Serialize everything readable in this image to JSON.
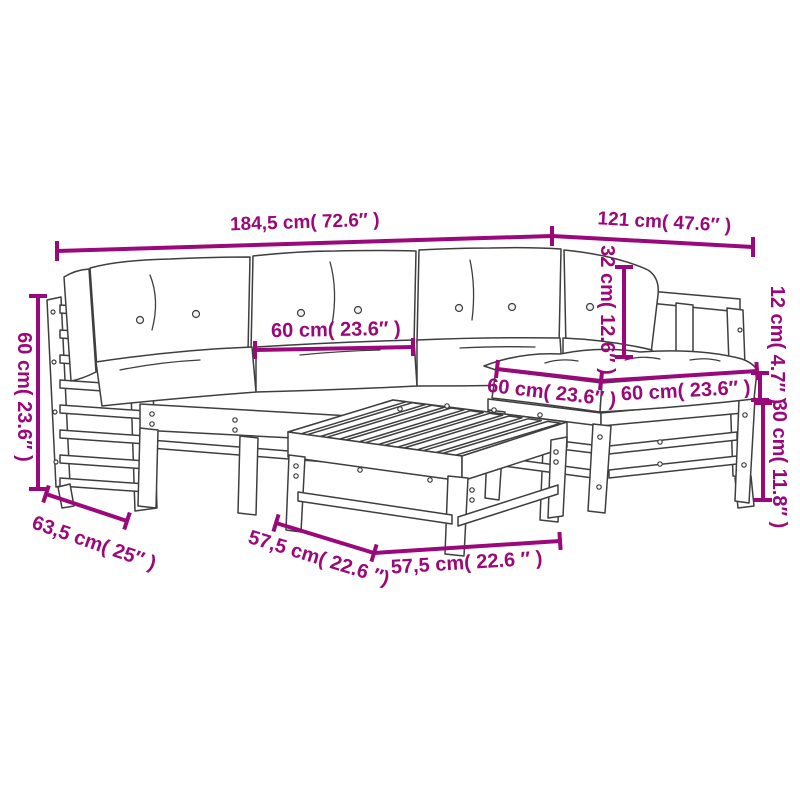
{
  "diagram": {
    "title": "garden-lounge-set-dimension-diagram",
    "product": "5 piece garden lounge set with cushions (corner sofas, middle sofa, footstool, slatted table)",
    "background_color": "#ffffff",
    "accent_color": "#9b0879",
    "line_art_color": "#3e3e3e"
  },
  "dimensions": {
    "sofa_total_width": "184,5 cm( 72.6″ )",
    "right_section_width": "121 cm( 47.6″ )",
    "armrest_height": "60 cm( 23.6″ )",
    "back_cushion_width": "60 cm( 23.6″ )",
    "back_cushion_height": "32 cm( 12.6″ )",
    "seat_cushion_thickness": "12 cm( 4.7″ )",
    "stool_frame_height": "30 cm( 11.8″ )",
    "sofa_depth": "63,5 cm( 25″ )",
    "table_depth": "57,5 cm( 22.6 ″)",
    "table_width": "57,5 cm( 22.6 ″ )",
    "stool_width_left": "60 cm( 23.6″ )",
    "stool_width_right": "60 cm( 23.6″ )"
  }
}
